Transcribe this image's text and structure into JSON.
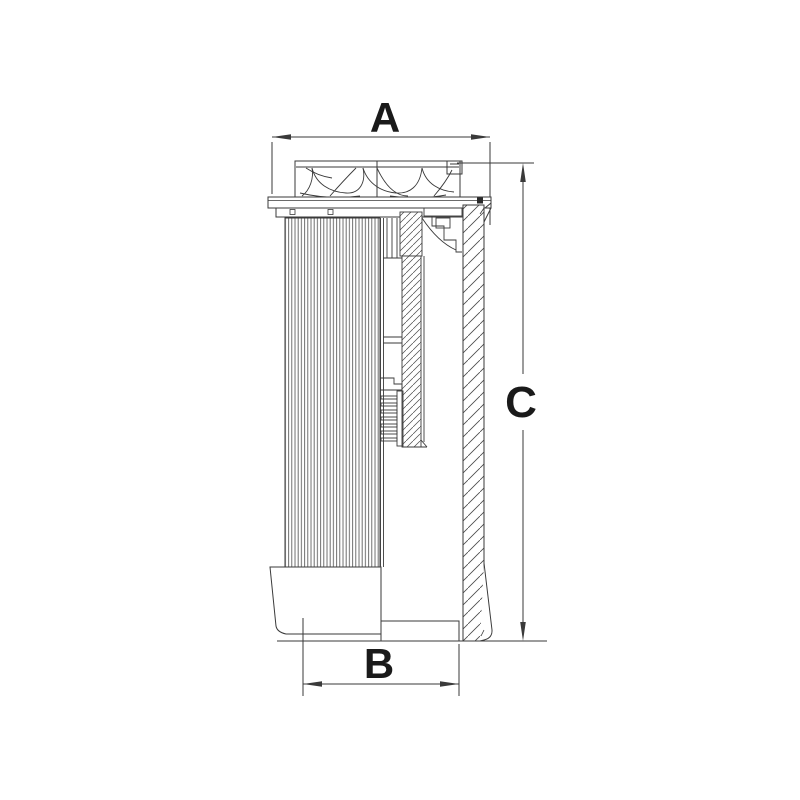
{
  "figure": {
    "type": "technical-line-drawing",
    "subject": "hydraulic-filter-element-cross-section",
    "background_color": "#ffffff",
    "line_color": "#3a3a3a",
    "label_color": "#1a1a1a"
  },
  "dimensions": {
    "top_width": {
      "label": "A"
    },
    "bottom_width": {
      "label": "B"
    },
    "height": {
      "label": "C"
    }
  }
}
